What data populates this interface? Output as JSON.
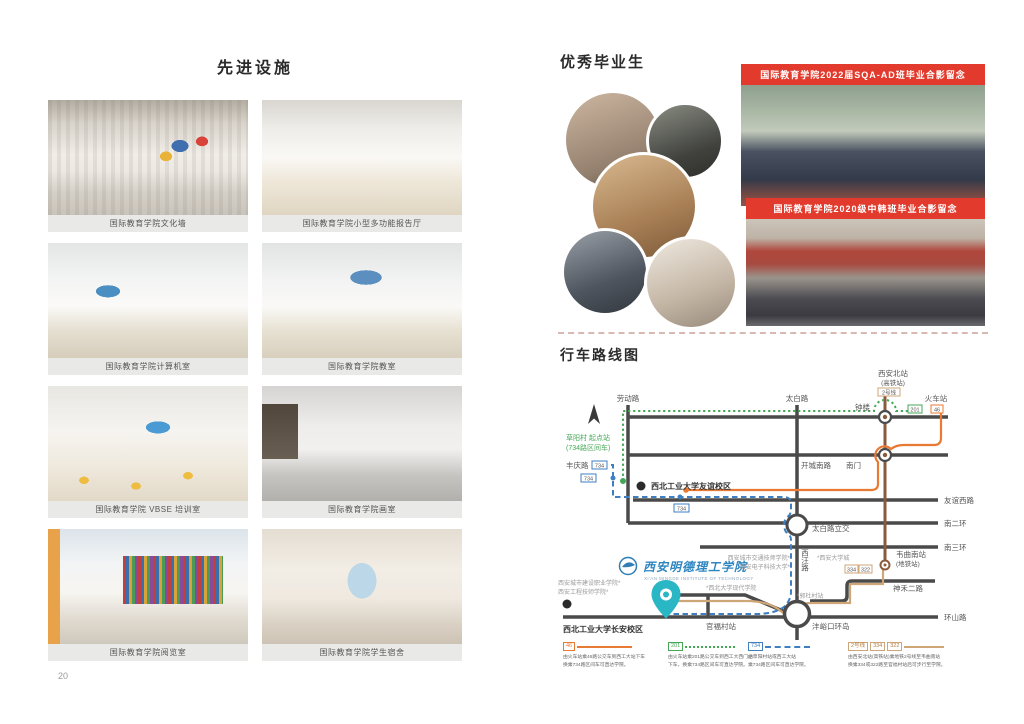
{
  "left_page": {
    "title": "先进设施",
    "page_number": "20",
    "facilities": [
      {
        "caption": "国际教育学院文化墙"
      },
      {
        "caption": "国际教育学院小型多功能报告厅"
      },
      {
        "caption": "国际教育学院计算机室"
      },
      {
        "caption": "国际教育学院教室"
      },
      {
        "caption": "国际教育学院 VBSE 培训室"
      },
      {
        "caption": "国际教育学院画室"
      },
      {
        "caption": "国际教育学院阅览室"
      },
      {
        "caption": "国际教育学院学生宿舍"
      }
    ]
  },
  "right_page": {
    "graduates_title": "优秀毕业生",
    "photo_banners": [
      "国际教育学院2022届SQA-AD班毕业合影留念",
      "国际教育学院2020级中韩班毕业合影留念"
    ],
    "map_title": "行车路线图",
    "map": {
      "north_station": "西安北站",
      "north_station_sub": "(高铁站)",
      "metro_badge": "2号线",
      "laodong_rd": "劳动路",
      "taibai_rd": "太白路",
      "bell_tower": "钟楼",
      "train_station": "火车站",
      "badge_201": "201",
      "badge_46": "46",
      "badge_734": "734",
      "caoyang": "草阳村 起点站",
      "caoyang_sub": "(734路区间车)",
      "fengqing_rd": "丰庆路",
      "kaicheng_rd": "开城南路",
      "south_gate": "南门",
      "youyi_west_rd": "友谊西路",
      "second_ring": "南二环",
      "third_ring": "南三环",
      "huanshan_rd": "环山路",
      "npu_youyi": "西北工业大学友谊校区",
      "taibai_interchange": "太白路立交",
      "xiwang_rd": "西汪路",
      "weiqu_south": "韦曲南站",
      "weiqu_south_sub": "(地铁站)",
      "badge_334": "334",
      "badge_322": "322",
      "shenhe_rd": "神禾二路",
      "guanfu_stop": "官福村站",
      "fengyukou": "沣峪口环岛",
      "npu_changan": "西北工业大学长安校区",
      "college_logo": "西安明德理工学院",
      "college_logo_en": "XI'AN MINGDE INSTITUTE OF TECHNOLOGY",
      "gray_labels": [
        "西安城市建设职业学院*",
        "西安工程技师学院*",
        "*西北大学现代学院",
        "西安城市交通技师学院*",
        "西安电子科技大学*",
        "*西安大学城",
        "*郭杜村站"
      ],
      "legend": [
        {
          "badges": [
            "46"
          ],
          "text1": "由火车站乘46路公交车到西工大站下车",
          "text2": "换乘734路区间车可直达学院。"
        },
        {
          "badges": [
            "201"
          ],
          "text1": "由火车站乘201路公交车到西工大西门站",
          "text2": "下车，换乘734路区间车可直达学院。"
        },
        {
          "badges": [
            "734"
          ],
          "text1": "由草阳村站或西工大站",
          "text2": "乘734路区间车可直达学院。"
        },
        {
          "badges": [
            "2号线",
            "334",
            "322"
          ],
          "text1": "由西安北站(高铁站)乘地铁2号线至韦曲南站",
          "text2": "换乘334或322路至官福村站后可步行至学院。"
        }
      ]
    }
  },
  "colors": {
    "banner_red": "#e23a2c",
    "route_orange": "#e87a33",
    "route_green": "#44a755",
    "route_blue": "#3f7fc1",
    "route_metro_brown": "#8a5a3a",
    "route_bus_tan": "#cfa678",
    "pin_teal": "#29b6c5"
  }
}
